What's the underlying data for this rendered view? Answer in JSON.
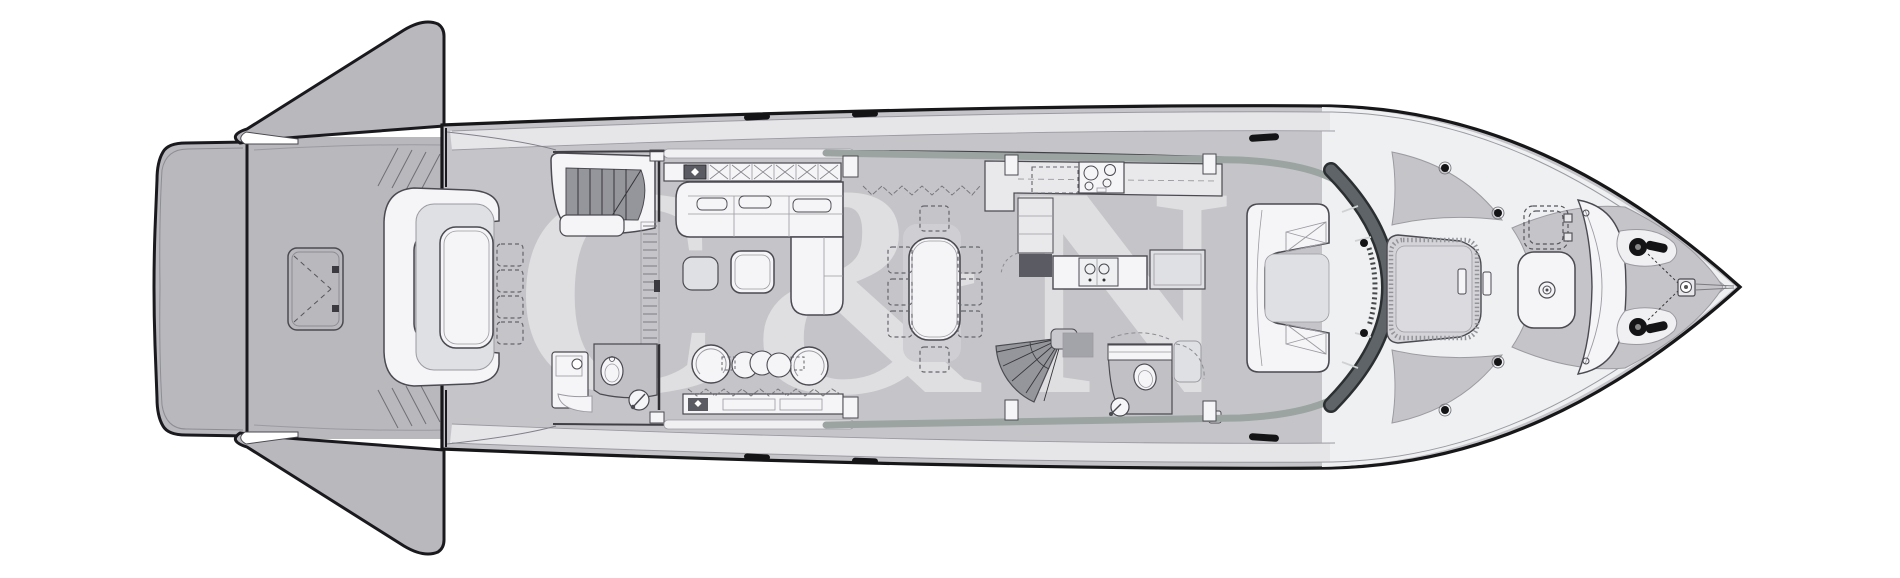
{
  "figure": {
    "type": "yacht-deck-plan",
    "subject": "motor-yacht main deck general arrangement, top-down view, bow to the right",
    "watermark_text": "C&N"
  },
  "colors": {
    "background": "#ffffff",
    "deck": "#c5c5c9",
    "aft_platform": "#b8b8bd",
    "walkway": "#e6e6e9",
    "foredeck": "#eff0f2",
    "furniture": "#f5f5f7",
    "cushion": "#dfe0e3",
    "pad": "#d4d4d8",
    "rug": "#cfcfd3",
    "stairs": "#95959c",
    "appliance_dark": "#5b5b63",
    "glass": "#5e6467",
    "window_strip": "#9ba4a0",
    "hardware": "#141417",
    "headroom": "#c0c0c5"
  },
  "parts": [
    "swim-platform",
    "fold-down-bulwark-top",
    "fold-down-bulwark-bottom",
    "tender-garage-hatch",
    "aft-deck-sofa",
    "aft-deck-table",
    "aft-deck-chairs",
    "flybridge-stairs",
    "sliding-glass-door",
    "aft-day-head",
    "salon-sideboard",
    "salon-sofa",
    "coffee-table",
    "ottoman",
    "swivel-armchairs",
    "nesting-tables",
    "lower-sideboard",
    "dining-table",
    "dining-chairs",
    "galley-counter",
    "cooktop",
    "extractor-hood",
    "galley-island",
    "galley-sink",
    "stairs-to-lower-deck",
    "forward-day-head",
    "helm-settee",
    "windshield",
    "side-window-band",
    "foredeck-sunpad",
    "foredeck-deck-hatch",
    "foredeck-table",
    "foredeck-bench",
    "anchor-windlass-port",
    "anchor-windlass-starboard",
    "bow-fitting",
    "mooring-cleats"
  ]
}
